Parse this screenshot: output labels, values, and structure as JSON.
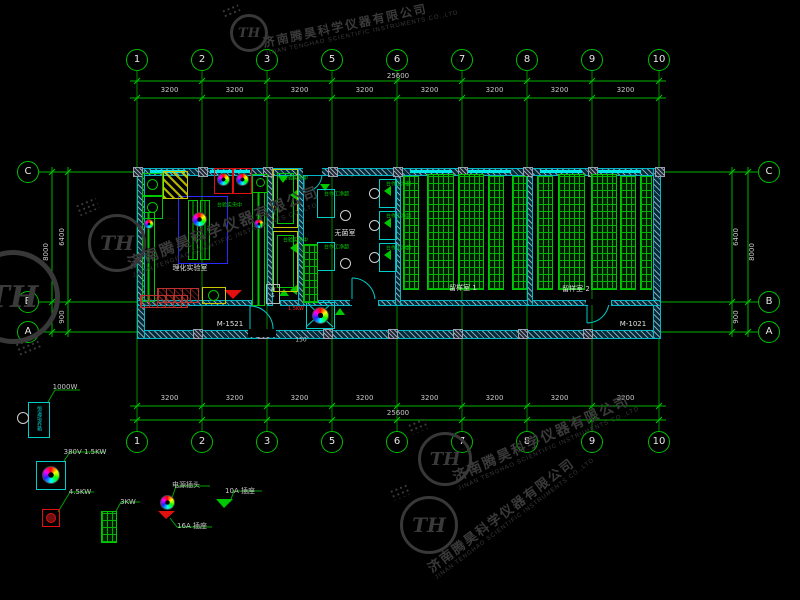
{
  "watermark": {
    "company_cn": "济南腾昊科学仪器有限公司",
    "company_en": "JINAN TENGHAO SCIENTIFIC INSTRUMENTS CO.,LTD",
    "logo_text": "TH"
  },
  "axes": {
    "top_labels": [
      "1",
      "2",
      "3",
      "5",
      "6",
      "7",
      "8",
      "9",
      "10"
    ],
    "bottom_labels": [
      "1",
      "2",
      "3",
      "5",
      "6",
      "7",
      "8",
      "9",
      "10"
    ],
    "left_labels": [
      "C",
      "B",
      "A"
    ],
    "right_labels": [
      "C",
      "B",
      "A"
    ]
  },
  "dimensions": {
    "top_segments": [
      "3200",
      "3200",
      "3200",
      "3200",
      "3200",
      "3200",
      "3200",
      "3200"
    ],
    "top_total": "25600",
    "bottom_segments": [
      "3200",
      "3200",
      "3200",
      "3200",
      "3200",
      "3200",
      "3200",
      "3200"
    ],
    "bottom_total": "25600",
    "left_inner": [
      "6400",
      "900"
    ],
    "left_total": "8000",
    "right_inner": [
      "6400",
      "900"
    ],
    "right_total": "8000",
    "door_offset": "150"
  },
  "rooms": {
    "lab": "理化实验室",
    "sterile": "无菌室",
    "sample1": "留样室 1",
    "sample2": "留样室 2"
  },
  "doors": {
    "left": "M-1521",
    "right": "M-1021"
  },
  "equipment": {
    "central_bench": "中央实验台",
    "clean_bench": "超净工作台",
    "ws": "WS",
    "autoclave_power": "1.5KW"
  },
  "legend": {
    "items": [
      {
        "name": "incubator-cabinet",
        "device": "恒温培养箱",
        "label": "1000W"
      },
      {
        "name": "autoclave",
        "label": "380V 1.5KW"
      },
      {
        "name": "heater-unit",
        "label": "4.5KW"
      },
      {
        "name": "drying-rack",
        "label": "3KW"
      },
      {
        "name": "power-plug",
        "label": "电源插头"
      },
      {
        "name": "socket-16a",
        "label": "16A 插座"
      },
      {
        "name": "socket-10a",
        "label": "10A 插座"
      }
    ]
  },
  "colors": {
    "grid_green": "#00b400",
    "wall_cyan": "#00c8c8",
    "bench_blue": "#2a2aff",
    "dim_text": "#c8c8c8",
    "watermark_gray": "#3a3a3a",
    "red": "#e01010",
    "yellow": "#c8c800"
  }
}
